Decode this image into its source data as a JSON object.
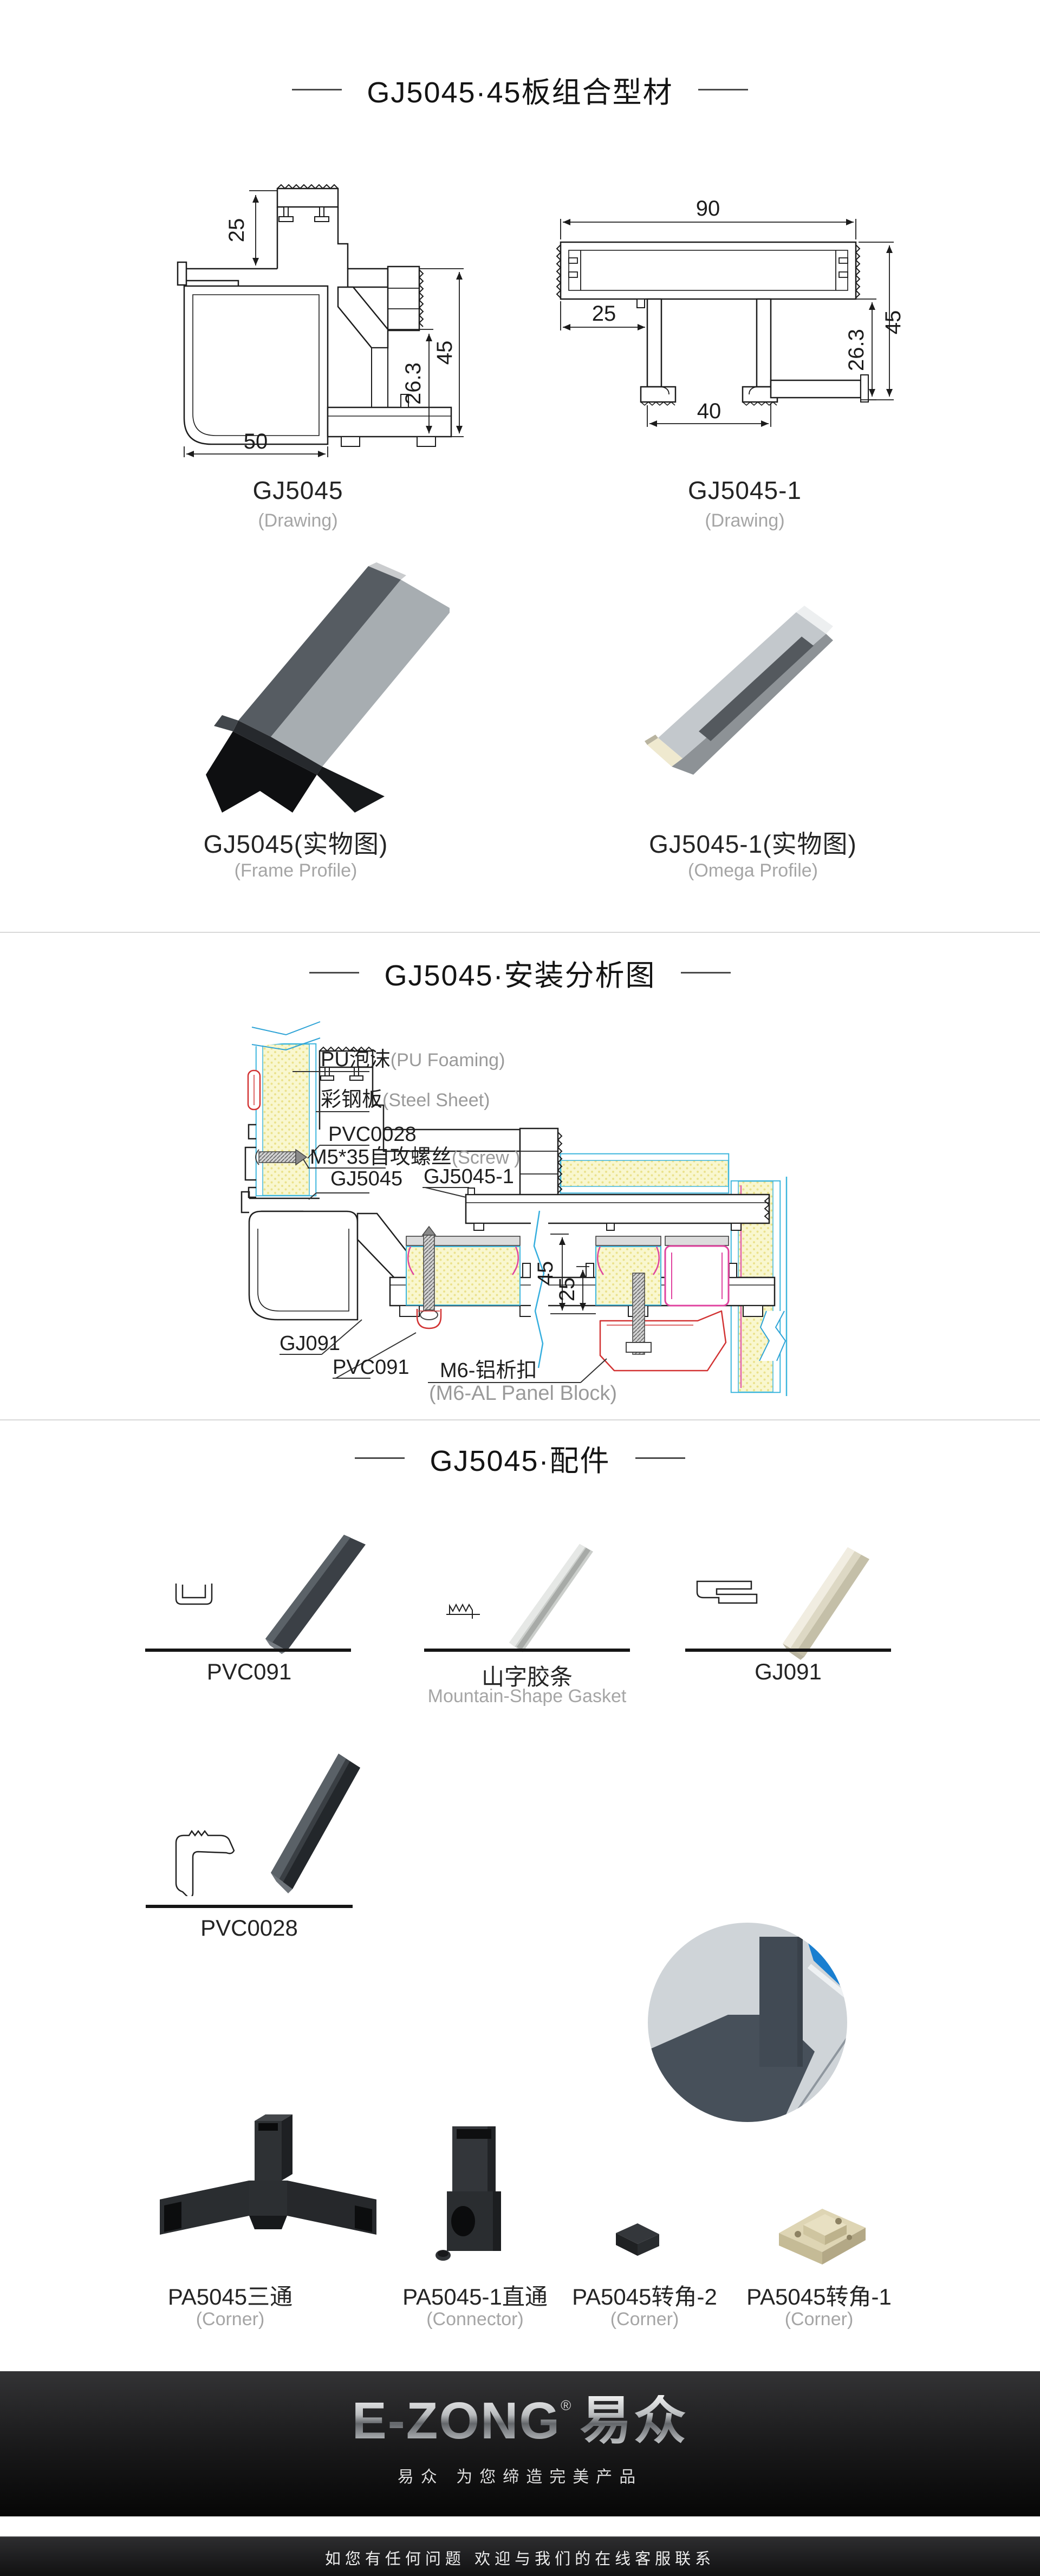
{
  "section1": {
    "title": "GJ5045·45板组合型材",
    "drawing1": {
      "code": "GJ5045",
      "sub": "(Drawing)",
      "dims": {
        "d25": "25",
        "d50": "50",
        "d263": "26.3",
        "d45": "45"
      }
    },
    "drawing2": {
      "code": "GJ5045-1",
      "sub": "(Drawing)",
      "dims": {
        "d90": "90",
        "d25": "25",
        "d40": "40",
        "d263": "26.3",
        "d45": "45"
      }
    },
    "photo1": {
      "code": "GJ5045(实物图)",
      "sub": "(Frame Profile)"
    },
    "photo2": {
      "code": "GJ5045-1(实物图)",
      "sub": "(Omega Profile)"
    }
  },
  "section2": {
    "title": "GJ5045·安装分析图",
    "labels": {
      "pu_cn": "PU泡沫",
      "pu_en": "(PU Foaming)",
      "steel_cn": "彩钢板",
      "steel_en": "(Steel Sheet)",
      "pvc0028": "PVC0028",
      "screw_cn": "M5*35自攻螺丝",
      "screw_en": "(Screw )",
      "gj5045": "GJ5045",
      "gj5045_1": "GJ5045-1",
      "gj091": "GJ091",
      "pvc091": "PVC091",
      "m6_cn": "M6-铝析扣",
      "m6_en": "(M6-AL Panel Block)",
      "d45": "45",
      "d25": "25"
    }
  },
  "section3": {
    "title": "GJ5045·配件",
    "items": [
      {
        "code": "PVC091",
        "sub": ""
      },
      {
        "code": "山字胶条",
        "sub": "Mountain-Shape Gasket"
      },
      {
        "code": "GJ091",
        "sub": ""
      },
      {
        "code": "PVC0028",
        "sub": ""
      },
      {
        "code": "PA5045三通",
        "sub": "(Corner)"
      },
      {
        "code": "PA5045-1直通",
        "sub": "(Connector)"
      },
      {
        "code": "PA5045转角-2",
        "sub": "(Corner)"
      },
      {
        "code": "PA5045转角-1",
        "sub": "(Corner)"
      }
    ]
  },
  "footer": {
    "brand_en": "E-ZONG",
    "brand_reg": "®",
    "brand_cn": "易众",
    "tagline": "易众 为您缔造完美产品",
    "service_note": "如您有任何问题    欢迎与我们的在线客服联系"
  }
}
